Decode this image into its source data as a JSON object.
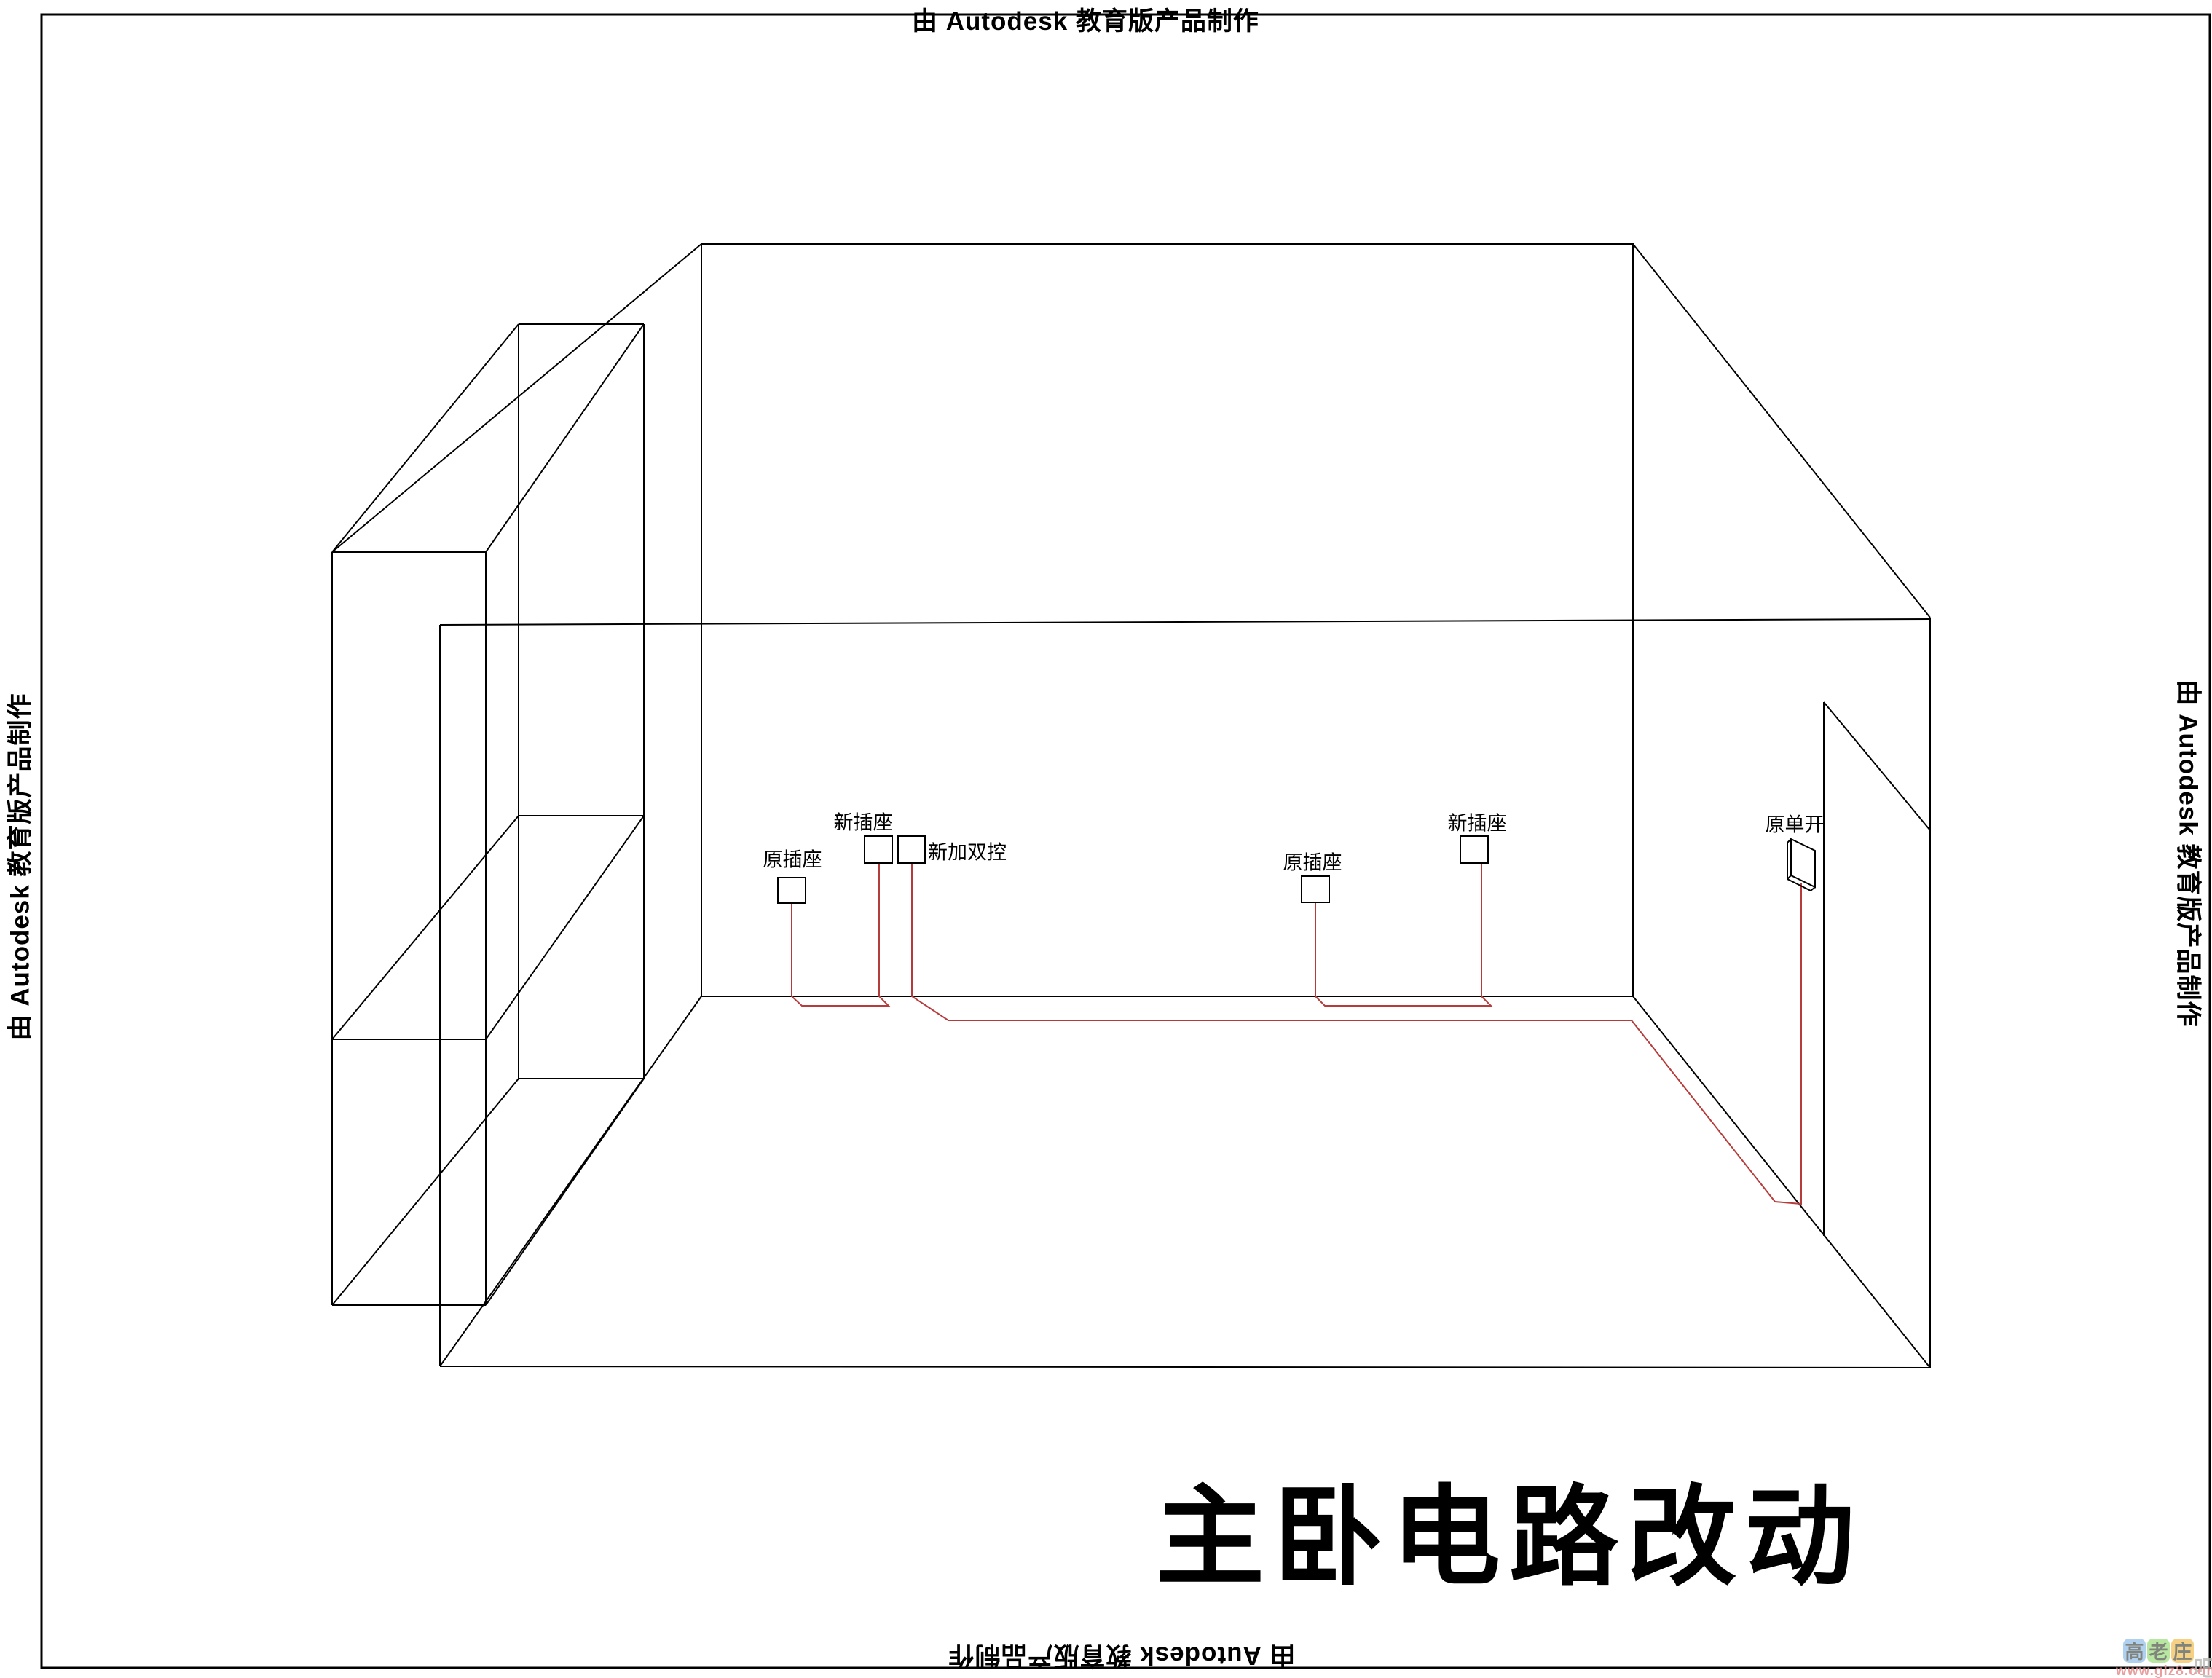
{
  "watermark": {
    "text": "由 Autodesk 教育版产品制作"
  },
  "title": {
    "text": "主卧电路改动"
  },
  "labels": {
    "socket_old_left": "原插座",
    "socket_new_left": "新插座",
    "dual_control_new": "新加双控",
    "socket_old_right": "原插座",
    "socket_new_right": "新插座",
    "switch_old": "原单开"
  },
  "site_logo": {
    "char1": "高",
    "char2": "老",
    "char3": "庄",
    "suffix": "吧",
    "url": "www.glz8.com",
    "tile_colors": [
      "#a3c8ee",
      "#abe391",
      "#f5c96f"
    ],
    "url_color": "#e58f90"
  },
  "colors": {
    "line_black": "#000000",
    "wire_red": "#b63c3c",
    "background": "#ffffff"
  }
}
